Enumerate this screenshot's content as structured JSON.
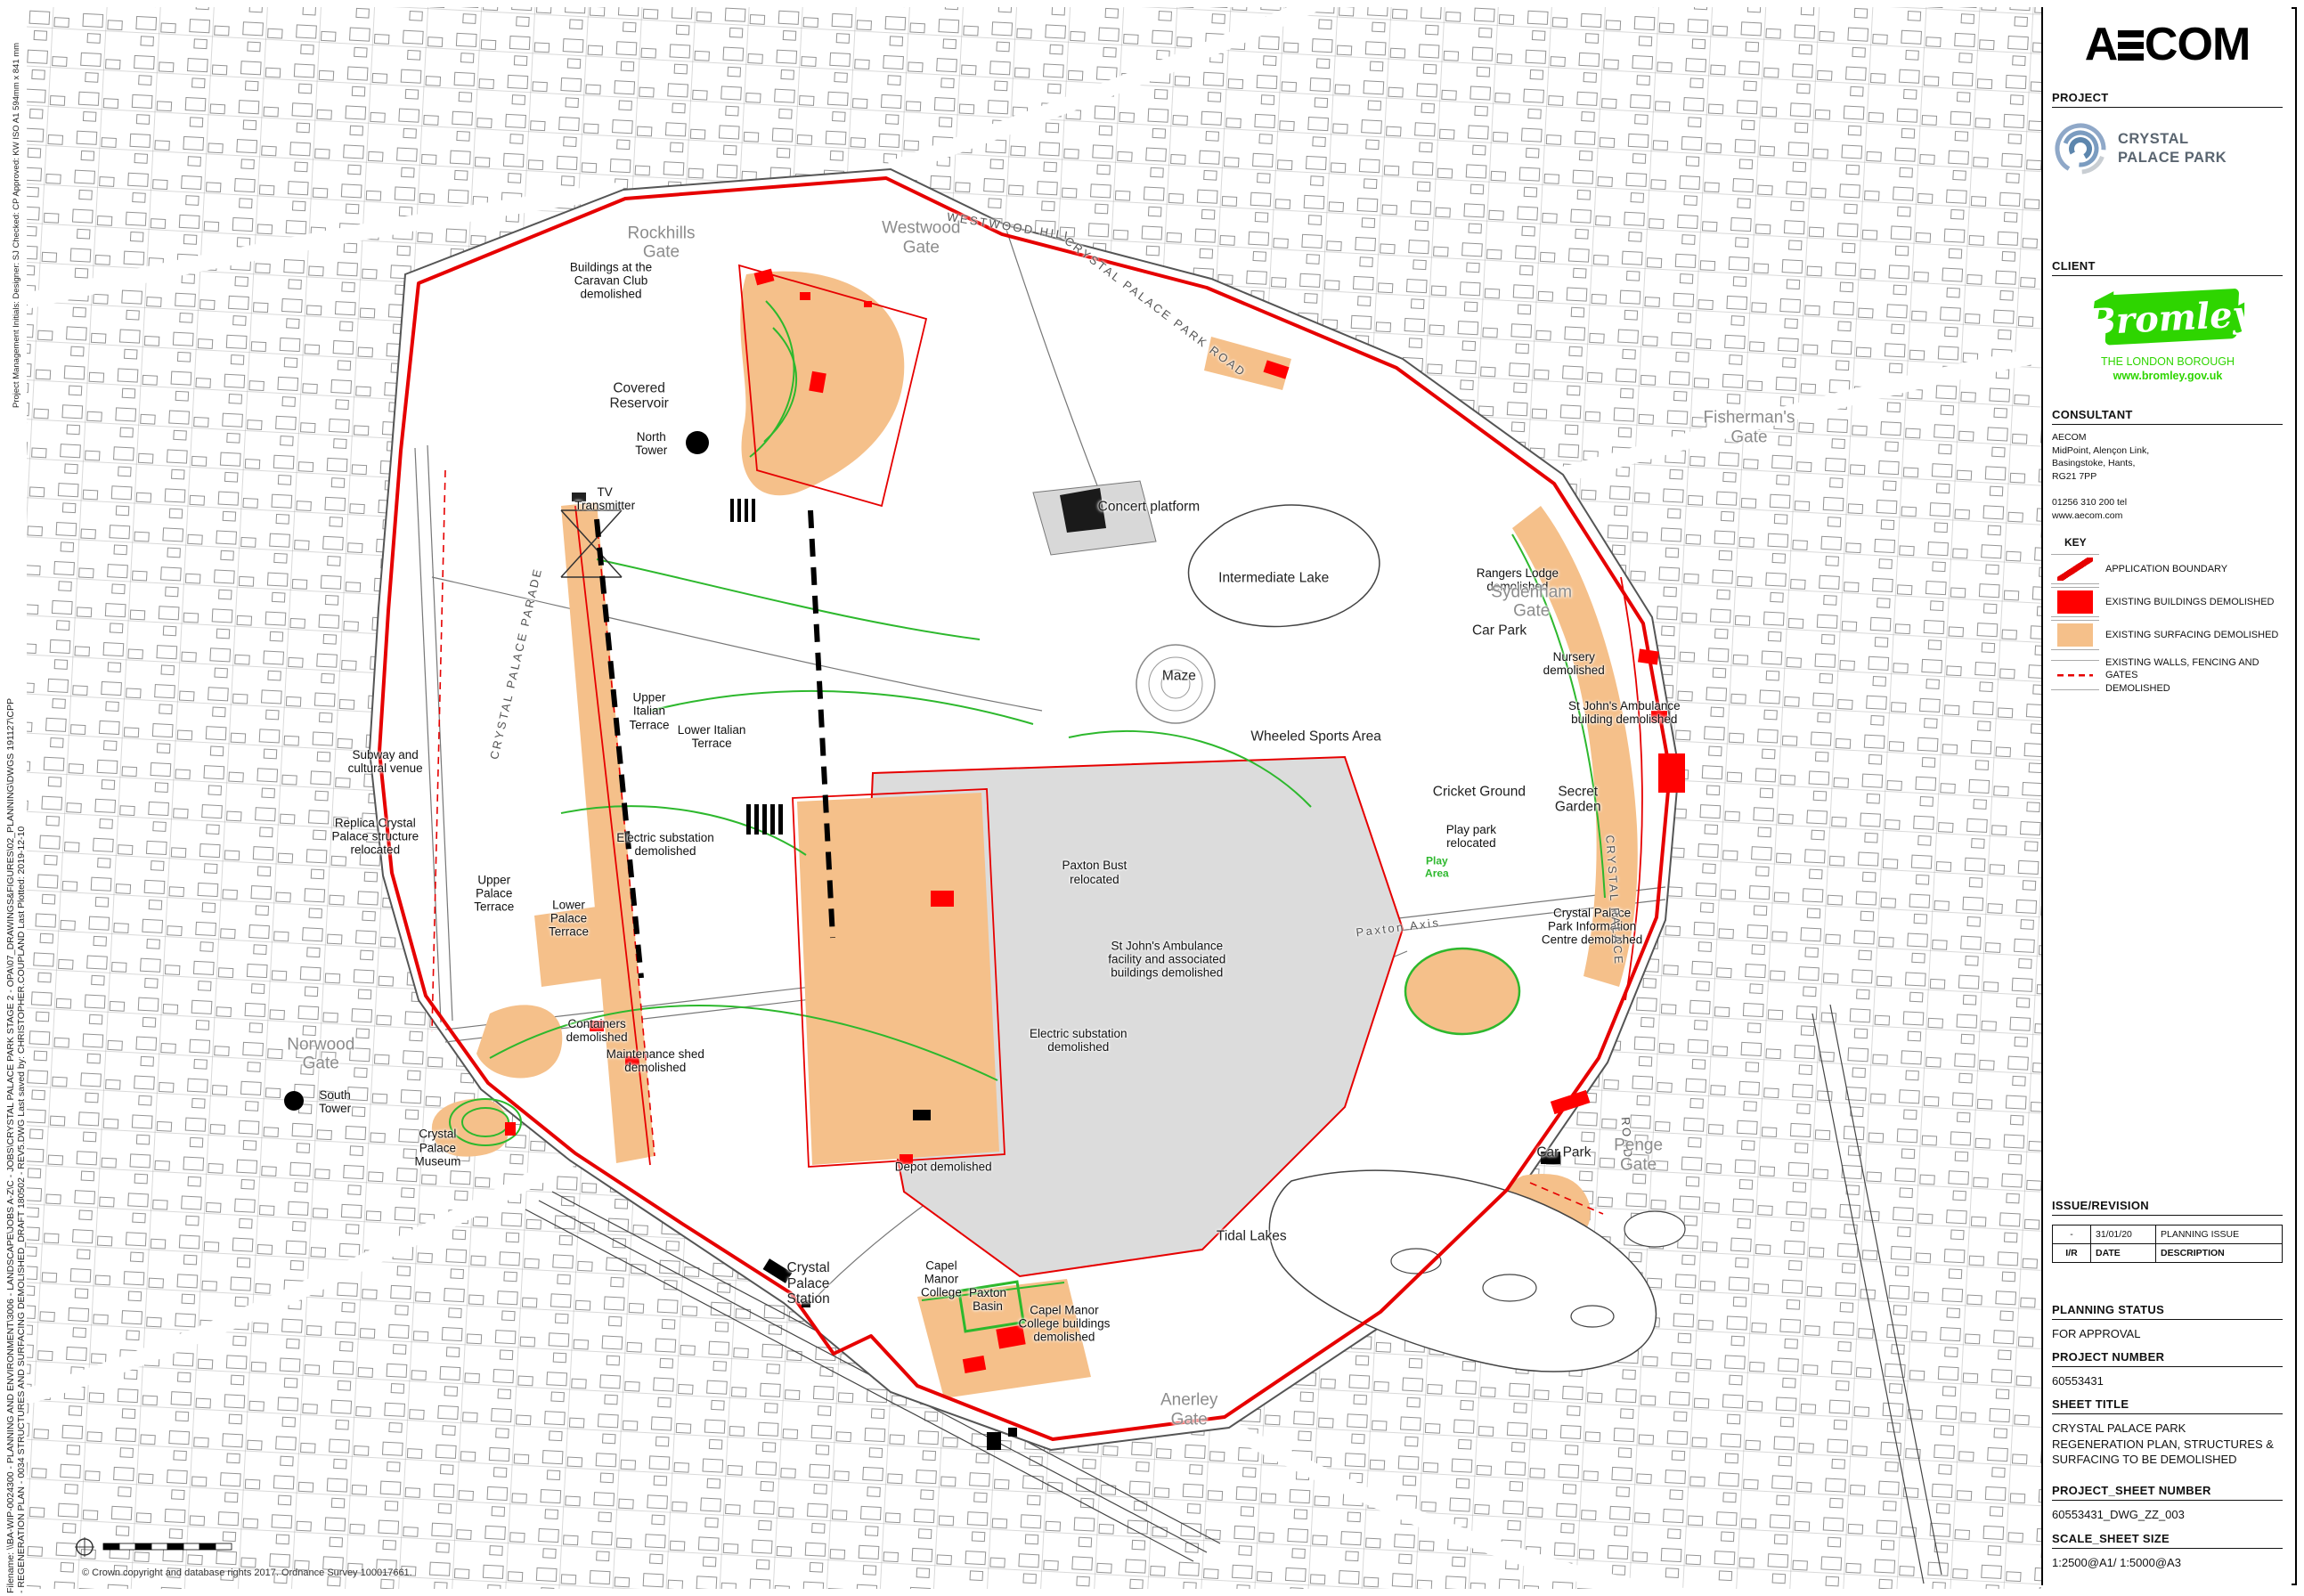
{
  "margins": {
    "meta": "Project Management Initials:    Designer: SJ      Checked: CP      Approved: KW      ISO A1 594mm x 841 mm",
    "filename_line1": "Filename: \\\\BA-WIP-0024300 - PLANNING AND ENVIRONMENT\\3006 - LANDSCAPE\\JOBS A-Z\\C - JOBS\\CRYSTAL PALACE PARK STAGE 2 - OPA\\07_DRAWINGS&FIGURES\\02_PLANNING\\DWGS 191127\\CPP",
    "filename_line2": "- REGENERATION PLAN - 0034 STRUCTURES AND SURFACING DEMOLISHED_DRAFT 180502 - REV5.DWG      Last saved by: CHRISTOPHER.COUPLAND      Last Plotted: 2019-12-10",
    "disclaimer": "This drawing has been prepared for the use of AECOM's client. It may not be used, modified, reproduced or relied upon by third parties, except as agreed by AECOM or as required by law. AECOM accepts no responsibility, and denies any liability whatsoever, to any party that uses or relies on this drawing without AECOM's express written consent. Do not scale this document. All measurements must be obtained from the stated dimensions."
  },
  "map": {
    "copyright": "© Crown copyright and database rights 2017. Ordnance Survey 100017661.",
    "colors": {
      "boundary_red": "#e60000",
      "building_red": "#ff0000",
      "surfacing_orange": "#f5c08a",
      "path_green": "#2db82d"
    },
    "labels": [
      {
        "text": "Rockhills\nGate",
        "x": 31.5,
        "y": 14.9,
        "cls": "gate"
      },
      {
        "text": "Westwood\nGate",
        "x": 44.4,
        "y": 14.6,
        "cls": "gate"
      },
      {
        "text": "WESTWOOD HILL",
        "x": 48.8,
        "y": 13.9,
        "rot": 9,
        "cls": "road"
      },
      {
        "text": "Buildings at the\nCaravan Club\ndemolished",
        "x": 29.0,
        "y": 17.3
      },
      {
        "text": "Covered\nReservoir",
        "x": 30.4,
        "y": 24.6,
        "cls": "area"
      },
      {
        "text": "North\nTower",
        "x": 31.0,
        "y": 27.6
      },
      {
        "text": "TV\nTransmitter",
        "x": 28.7,
        "y": 31.1
      },
      {
        "text": "CRYSTAL PALACE PARK ROAD",
        "x": 56.0,
        "y": 19.0,
        "rot": 37,
        "cls": "road"
      },
      {
        "text": "Concert platform",
        "x": 55.7,
        "y": 31.6,
        "cls": "area"
      },
      {
        "text": "Intermediate Lake",
        "x": 61.9,
        "y": 36.1,
        "cls": "area"
      },
      {
        "text": "Maze",
        "x": 57.2,
        "y": 42.3,
        "cls": "area"
      },
      {
        "text": "Wheeled Sports Area",
        "x": 64.0,
        "y": 46.1,
        "cls": "area"
      },
      {
        "text": "Rangers Lodge\ndemolished",
        "x": 74.0,
        "y": 36.2
      },
      {
        "text": "Sydenham\nGate",
        "x": 74.7,
        "y": 37.6,
        "cls": "gate"
      },
      {
        "text": "Car Park",
        "x": 73.1,
        "y": 39.4,
        "cls": "area"
      },
      {
        "text": "Nursery\ndemolished",
        "x": 76.8,
        "y": 41.5
      },
      {
        "text": "St John's Ambulance\nbuilding demolished",
        "x": 79.3,
        "y": 44.6
      },
      {
        "text": "Fisherman's\nGate",
        "x": 85.5,
        "y": 26.6,
        "cls": "gate"
      },
      {
        "text": "Cricket Ground",
        "x": 72.1,
        "y": 49.6,
        "cls": "area"
      },
      {
        "text": "Secret\nGarden",
        "x": 77.0,
        "y": 50.1,
        "cls": "area"
      },
      {
        "text": "Play park\nrelocated",
        "x": 71.7,
        "y": 52.4
      },
      {
        "text": "Play\nArea",
        "x": 70.0,
        "y": 54.4,
        "cls": "green"
      },
      {
        "text": "Paxton Axis",
        "x": 68.1,
        "y": 58.2,
        "rot": -7,
        "cls": "road"
      },
      {
        "text": "Crystal Palace\nPark Information\nCentre demolished",
        "x": 77.7,
        "y": 58.1
      },
      {
        "text": "CRYSTAL PALACE",
        "x": 78.8,
        "y": 56.5,
        "rot": 86,
        "cls": "road"
      },
      {
        "text": "ROAD",
        "x": 79.4,
        "y": 71.5,
        "rot": 86,
        "cls": "road"
      },
      {
        "text": "Car Park",
        "x": 76.3,
        "y": 72.4,
        "cls": "area"
      },
      {
        "text": "Penge\nGate",
        "x": 80.0,
        "y": 72.6,
        "cls": "gate"
      },
      {
        "text": "Subway and\ncultural venue",
        "x": 17.8,
        "y": 47.7
      },
      {
        "text": "Replica Crystal\nPalace structure\nrelocated",
        "x": 17.3,
        "y": 52.4
      },
      {
        "text": "Upper\nPalace\nTerrace",
        "x": 23.2,
        "y": 56.0
      },
      {
        "text": "Lower\nPalace\nTerrace",
        "x": 26.9,
        "y": 57.6
      },
      {
        "text": "Electric substation\ndemolished",
        "x": 31.7,
        "y": 52.9
      },
      {
        "text": "Upper\nItalian\nTerrace",
        "x": 30.9,
        "y": 44.5
      },
      {
        "text": "Lower Italian\nTerrace",
        "x": 34.0,
        "y": 46.1
      },
      {
        "text": "Paxton Bust\nrelocated",
        "x": 53.0,
        "y": 54.7
      },
      {
        "text": "St John's Ambulance\nfacility and associated\nbuildings demolished",
        "x": 56.6,
        "y": 60.2
      },
      {
        "text": "Electric substation\ndemolished",
        "x": 52.2,
        "y": 65.3
      },
      {
        "text": "Containers\ndemolished",
        "x": 28.3,
        "y": 64.7
      },
      {
        "text": "Maintenance shed\ndemolished",
        "x": 31.2,
        "y": 66.6
      },
      {
        "text": "Norwood\nGate",
        "x": 14.6,
        "y": 66.2,
        "cls": "gate"
      },
      {
        "text": "South\nTower",
        "x": 15.3,
        "y": 69.2
      },
      {
        "text": "Crystal\nPalace\nMuseum",
        "x": 20.4,
        "y": 72.1
      },
      {
        "text": "Depot demolished",
        "x": 45.5,
        "y": 73.3
      },
      {
        "text": "Crystal\nPalace\nStation",
        "x": 38.8,
        "y": 80.7,
        "cls": "area"
      },
      {
        "text": "Capel\nManor\nCollege",
        "x": 45.4,
        "y": 80.4
      },
      {
        "text": "Paxton\nBasin",
        "x": 47.7,
        "y": 81.7
      },
      {
        "text": "Capel Manor\nCollege buildings\ndemolished",
        "x": 51.5,
        "y": 83.2
      },
      {
        "text": "Tidal Lakes",
        "x": 60.8,
        "y": 77.7,
        "cls": "area"
      },
      {
        "text": "Anerley\nGate",
        "x": 57.7,
        "y": 88.7,
        "cls": "gate"
      },
      {
        "text": "CRYSTAL PALACE PARADE",
        "x": 24.3,
        "y": 41.5,
        "rot": -77,
        "cls": "road"
      }
    ]
  },
  "titleblock": {
    "logo": "AECOM",
    "project": {
      "label": "PROJECT",
      "name": "CRYSTAL\nPALACE PARK"
    },
    "client": {
      "label": "CLIENT",
      "logo_text": "Bromley",
      "tagline": "THE LONDON BOROUGH",
      "url": "www.bromley.gov.uk"
    },
    "consultant": {
      "label": "CONSULTANT",
      "address": "AECOM\nMidPoint, Alençon Link,\nBasingstoke, Hants,\nRG21 7PP\n\n01256 310 200 tel\nwww.aecom.com"
    },
    "key": {
      "label": "KEY",
      "items": [
        {
          "swatch": "line",
          "label": "APPLICATION BOUNDARY"
        },
        {
          "swatch": "red",
          "label": "EXISTING BUILDINGS DEMOLISHED"
        },
        {
          "swatch": "orange",
          "label": "EXISTING SURFACING DEMOLISHED"
        },
        {
          "swatch": "dash",
          "label": "EXISTING WALLS, FENCING AND GATES\nDEMOLISHED"
        }
      ]
    },
    "issue_revision": {
      "label": "ISSUE/REVISION",
      "rows": [
        [
          "-",
          "31/01/20",
          "PLANNING ISSUE"
        ]
      ],
      "headers": [
        "I/R",
        "DATE",
        "DESCRIPTION"
      ]
    },
    "planning_status": {
      "label": "PLANNING STATUS",
      "value": "FOR APPROVAL"
    },
    "project_number": {
      "label": "PROJECT NUMBER",
      "value": "60553431"
    },
    "sheet_title": {
      "label": "SHEET TITLE",
      "value": "CRYSTAL PALACE PARK\nREGENERATION PLAN, STRUCTURES &\nSURFACING TO BE DEMOLISHED"
    },
    "project_sheet_number": {
      "label": "PROJECT_SHEET NUMBER",
      "value": "60553431_DWG_ZZ_003"
    },
    "scale_sheet_size": {
      "label": "SCALE_SHEET SIZE",
      "value": "1:2500@A1/ 1:5000@A3"
    }
  }
}
